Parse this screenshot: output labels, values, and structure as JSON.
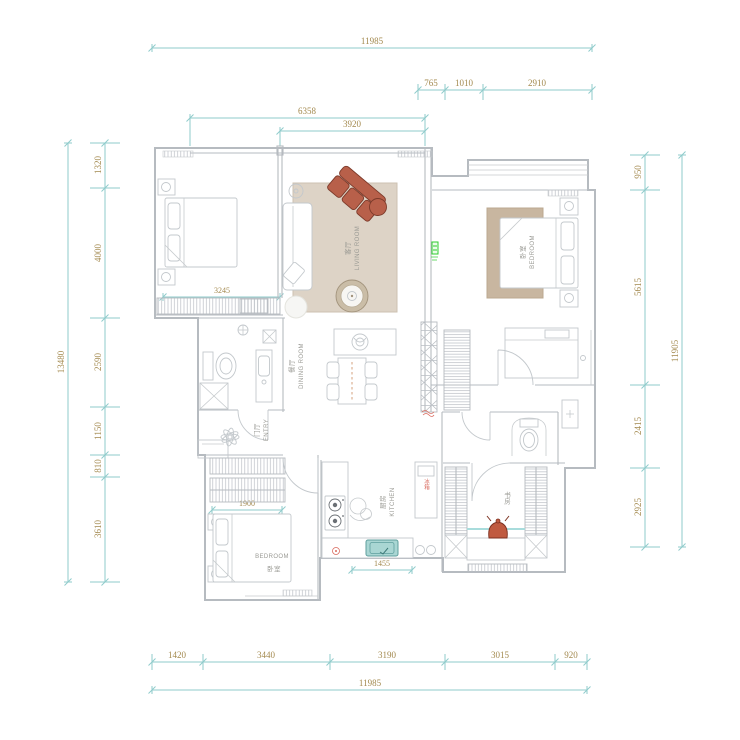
{
  "plan": {
    "rooms": {
      "living": {
        "zh": "客厅",
        "en": "LIVING ROOM"
      },
      "bedroom_right": {
        "zh": "卧室",
        "en": "BEDROOM"
      },
      "bedroom_bottom": {
        "zh": "卧室",
        "en": "BEDROOM"
      },
      "dining": {
        "zh": "餐厅",
        "en": "DINING ROOM"
      },
      "entry": {
        "zh": "门厅",
        "en": "ENTRY"
      },
      "kitchen": {
        "zh": "厨房",
        "en": "KITCHEN"
      },
      "study": {
        "zh": "书房"
      }
    },
    "annotations": {
      "fridge": "冰箱"
    }
  },
  "dims": {
    "top_outer": "11985",
    "top_row2": [
      "765",
      "1010",
      "2910"
    ],
    "top_6358": "6358",
    "top_3920": "3920",
    "left_outer": "13480",
    "left_col": [
      "1320",
      "4000",
      "2590",
      "1150",
      "810",
      "3610"
    ],
    "right_outer": "11905",
    "right_col": [
      "950",
      "5615",
      "2415",
      "2925"
    ],
    "bottom_row": [
      "1420",
      "3440",
      "3190",
      "3015",
      "920"
    ],
    "bottom_outer": "11985",
    "interior": {
      "bedroom_window": "3245",
      "wardrobe": "1900",
      "kitchen_counter": "1455"
    }
  },
  "colors": {
    "dim_line": "#8fcbcb",
    "dim_text": "#a3894e",
    "wall": "#b6bbc0",
    "rug_living": "#ddd3c6",
    "rug_bedroom": "#c8b6a0",
    "sofa_red": "#b8604a",
    "sink_teal": "#a9d6d3",
    "teapot": "#c05a40",
    "accent_red": "#d96a5e",
    "accent_green": "#2ecc2e",
    "label_gray": "#9a9a94"
  }
}
